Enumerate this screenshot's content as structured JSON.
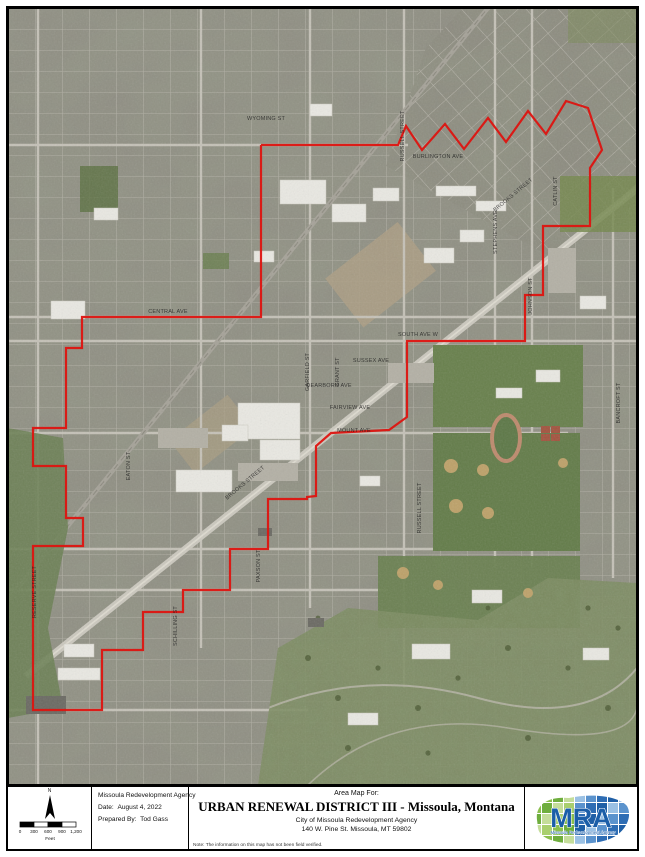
{
  "map": {
    "base_color": "#8f8d83",
    "boundary_color": "#dd1410",
    "boundary_points": "253,137 390,137 398,118 414,142 437,116 456,141 480,110 498,134 520,103 538,126 558,93 580,100 594,142 582,160 582,218 535,218 535,287 517,287 517,333 399,333 399,409 381,422 323,425 308,438 308,488 299,489 299,491 260,491 260,541 222,541 222,582 175,582 175,604 135,604 135,642 94,642 94,702 25,702 25,538 75,538 75,510 58,510 58,458 25,458 25,420 58,420 58,340 74,340 74,309 253,309 253,137",
    "street_labels": [
      {
        "text": "WYOMING ST",
        "x": 258,
        "y": 112,
        "rot": 0
      },
      {
        "text": "RUSSELL STREET",
        "x": 396,
        "y": 128,
        "rot": -90
      },
      {
        "text": "BURLINGTON AVE",
        "x": 430,
        "y": 150,
        "rot": 0
      },
      {
        "text": "CATLIN ST",
        "x": 549,
        "y": 183,
        "rot": -90
      },
      {
        "text": "BROOKS STREET",
        "x": 506,
        "y": 188,
        "rot": -40
      },
      {
        "text": "STEPHENS AVE",
        "x": 489,
        "y": 224,
        "rot": -90
      },
      {
        "text": "JOHNSON ST",
        "x": 524,
        "y": 288,
        "rot": -90
      },
      {
        "text": "CENTRAL AVE",
        "x": 160,
        "y": 305,
        "rot": 0
      },
      {
        "text": "SOUTH AVE W",
        "x": 410,
        "y": 328,
        "rot": 0
      },
      {
        "text": "SUSSEX AVE",
        "x": 363,
        "y": 354,
        "rot": 0
      },
      {
        "text": "GARFIELD ST",
        "x": 301,
        "y": 364,
        "rot": -90
      },
      {
        "text": "GRANT ST",
        "x": 331,
        "y": 364,
        "rot": -90
      },
      {
        "text": "DEARBORN AVE",
        "x": 321,
        "y": 379,
        "rot": 0
      },
      {
        "text": "FAIRVIEW AVE",
        "x": 342,
        "y": 401,
        "rot": 0
      },
      {
        "text": "BANCROFT ST",
        "x": 612,
        "y": 395,
        "rot": -90
      },
      {
        "text": "MOUNT AVE",
        "x": 346,
        "y": 424,
        "rot": 0
      },
      {
        "text": "EATON ST",
        "x": 122,
        "y": 458,
        "rot": -90
      },
      {
        "text": "BROOKS STREET",
        "x": 238,
        "y": 476,
        "rot": -40
      },
      {
        "text": "RUSSELL STREET",
        "x": 413,
        "y": 500,
        "rot": -90
      },
      {
        "text": "RESERVE STREET",
        "x": 28,
        "y": 584,
        "rot": -90
      },
      {
        "text": "PAXSON ST",
        "x": 252,
        "y": 558,
        "rot": -90
      },
      {
        "text": "SCHILLING ST",
        "x": 169,
        "y": 618,
        "rot": -90
      }
    ]
  },
  "title_block": {
    "north_label": "N",
    "scale": {
      "ticks": [
        "0",
        "300",
        "600",
        "900",
        "1,200"
      ],
      "unit": "Feet"
    },
    "agency": "Missoula Redevelopment Agency",
    "date_label": "Date:",
    "date_value": "August 4, 2022",
    "prepared_label": "Prepared By:",
    "prepared_value": "Tod Gass",
    "area_map_for": "Area Map For:",
    "title": "URBAN RENEWAL DISTRICT III - Missoula, Montana",
    "subtitle1": "City of Missoula Redevelopment Agency",
    "subtitle2": "140 W. Pine St.   Missoula, MT 59802",
    "note": "Note:  The information on this map has not been field verified.",
    "logo": {
      "text": "MRA",
      "subtext": "Missoula Redevelopment Agency",
      "greens": [
        "#a9cf6e",
        "#8bbf4e",
        "#6fae3e",
        "#c4dd9a"
      ],
      "blues": [
        "#9bc1e4",
        "#5b93cd",
        "#2e6db4",
        "#1f5fa6"
      ],
      "text_color": "#1b5ea8"
    }
  }
}
